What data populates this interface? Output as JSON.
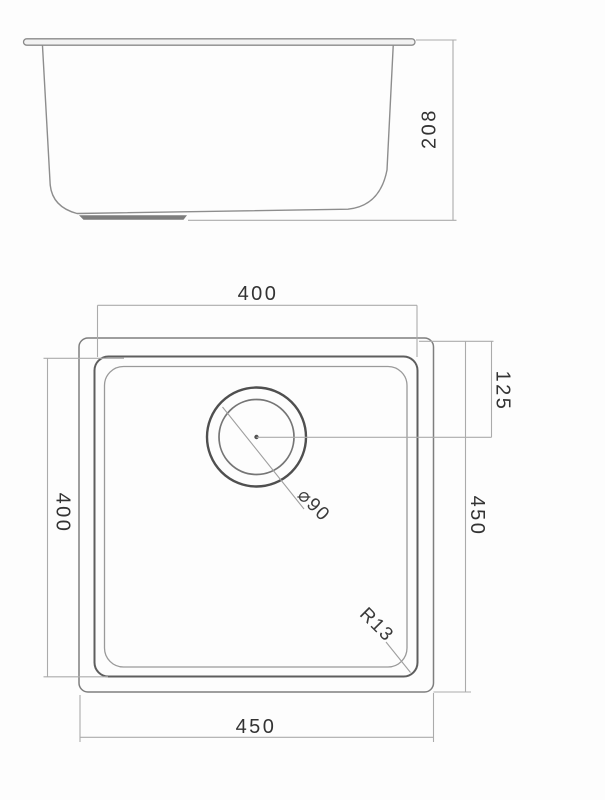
{
  "drawing": {
    "description_labels": {
      "depth": "208",
      "top_width": "400",
      "left_height": "400",
      "right_height": "450",
      "drain_offset": "125",
      "bottom_width": "450",
      "drain_diameter": "⌀90",
      "corner_radius": "R13"
    },
    "colors": {
      "background": "#fdfdfd",
      "geometry_line": "#7e7e7e",
      "rim_line": "#5e5e5e",
      "dimension_line": "#ababab",
      "text": "#333333"
    }
  }
}
